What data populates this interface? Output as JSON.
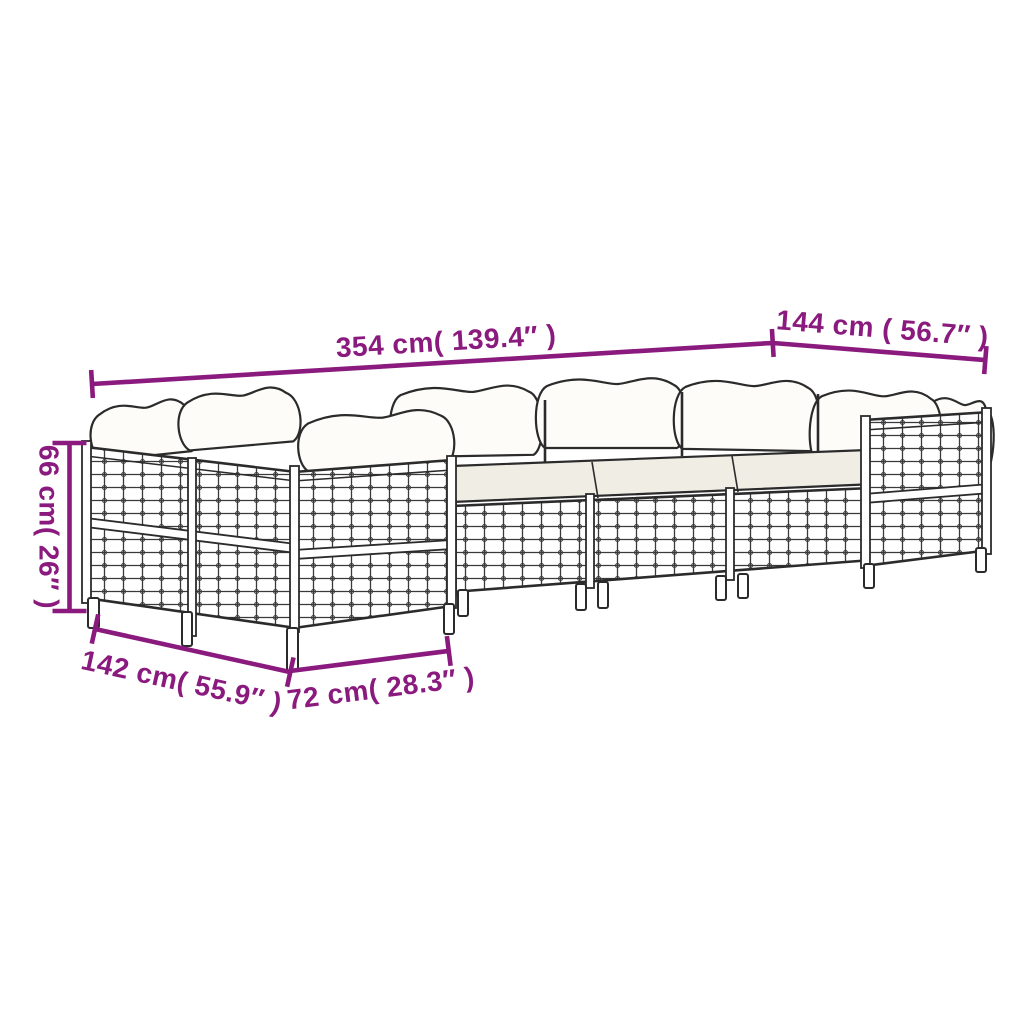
{
  "page": {
    "background": "#ffffff",
    "kind": "product dimension diagram",
    "subject": "Line drawing of a modular poly-rattan garden lounge set (sectional sofa with back cushions, seat cushions, lattice panels and legs)"
  },
  "colors": {
    "dimension_annotation": "#8a1a7e",
    "drawing_line": "#2b2b2b",
    "back_cushion_fill": "#fdfcf9",
    "seat_cushion_fill": "#f0ede4"
  },
  "dimensions": {
    "total_width": {
      "value_cm": 354,
      "value_inch": 139.4,
      "label": "354 cm( 139.4″ )"
    },
    "right_section": {
      "value_cm": 144,
      "value_inch": 56.7,
      "label": "144 cm ( 56.7″ )"
    },
    "height": {
      "value_cm": 66,
      "value_inch": 26,
      "label": "66 cm( 26″ )"
    },
    "left_section": {
      "value_cm": 142,
      "value_inch": 55.9,
      "label": "142 cm( 55.9″ )"
    },
    "module_width": {
      "value_cm": 72,
      "value_inch": 28.3,
      "label": "72 cm( 28.3″ )"
    }
  }
}
